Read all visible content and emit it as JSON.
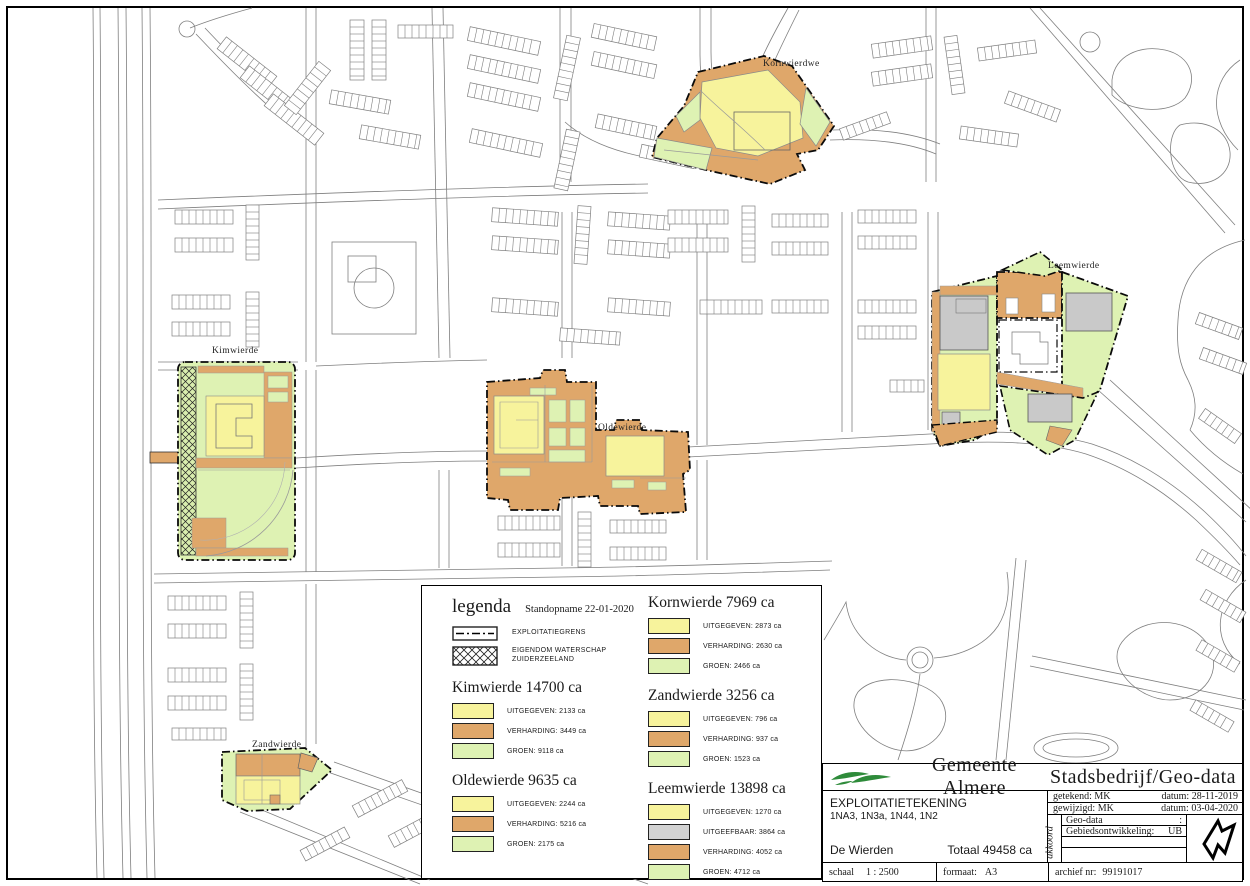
{
  "map": {
    "zone_labels": [
      {
        "id": "kornwierde",
        "text": "Kornwierdwe"
      },
      {
        "id": "kimwierde",
        "text": "Kimwierde"
      },
      {
        "id": "oldewierde",
        "text": "Oldewierde"
      },
      {
        "id": "zandwierde",
        "text": "Zandwierde"
      },
      {
        "id": "leemwierde",
        "text": "Leemwierde"
      }
    ]
  },
  "legend": {
    "title": "legenda",
    "subtitle": "Standopname 22-01-2020",
    "symbols": [
      {
        "key": "exploitatiegrens",
        "label": "EXPLOITATIEGRENS"
      },
      {
        "key": "eigendom-waterschap",
        "label": "EIGENDOM WATERSCHAP ZUIDERZEELAND"
      }
    ],
    "colors": {
      "uitgegeven": "#f7f39c",
      "verharding": "#dfa76a",
      "groen": "#def2b3",
      "uitgeefbaar": "#d2d2d2"
    },
    "columns": [
      {
        "sections": [
          {
            "name": "Kimwierde",
            "total": "14700 ca",
            "rows": [
              {
                "key": "uitgegeven",
                "label": "UITGEGEVEN:",
                "value": "2133 ca"
              },
              {
                "key": "verharding",
                "label": "VERHARDING:",
                "value": "3449 ca"
              },
              {
                "key": "groen",
                "label": "GROEN:",
                "value": "9118 ca"
              }
            ]
          },
          {
            "name": "Oldewierde",
            "total": "9635 ca",
            "rows": [
              {
                "key": "uitgegeven",
                "label": "UITGEGEVEN:",
                "value": "2244 ca"
              },
              {
                "key": "verharding",
                "label": "VERHARDING:",
                "value": "5216 ca"
              },
              {
                "key": "groen",
                "label": "GROEN:",
                "value": "2175 ca"
              }
            ]
          }
        ]
      },
      {
        "sections": [
          {
            "name": "Kornwierde",
            "total": "7969 ca",
            "rows": [
              {
                "key": "uitgegeven",
                "label": "UITGEGEVEN:",
                "value": "2873 ca"
              },
              {
                "key": "verharding",
                "label": "VERHARDING:",
                "value": "2630 ca"
              },
              {
                "key": "groen",
                "label": "GROEN:",
                "value": "2466 ca"
              }
            ]
          },
          {
            "name": "Zandwierde",
            "total": "3256 ca",
            "rows": [
              {
                "key": "uitgegeven",
                "label": "UITGEGEVEN:",
                "value": "796 ca"
              },
              {
                "key": "verharding",
                "label": "VERHARDING:",
                "value": "937 ca"
              },
              {
                "key": "groen",
                "label": "GROEN:",
                "value": "1523 ca"
              }
            ]
          },
          {
            "name": "Leemwierde",
            "total": "13898 ca",
            "rows": [
              {
                "key": "uitgegeven",
                "label": "UITGEGEVEN:",
                "value": "1270 ca"
              },
              {
                "key": "uitgeefbaar",
                "label": "UITGEEFBAAR:",
                "value": "3864 ca"
              },
              {
                "key": "verharding",
                "label": "VERHARDING:",
                "value": "4052 ca"
              },
              {
                "key": "groen",
                "label": "GROEN:",
                "value": "4712 ca"
              }
            ]
          }
        ]
      }
    ]
  },
  "titleblock": {
    "org": "Gemeente Almere",
    "dept": "Stadsbedrijf/Geo-data",
    "doc_type": "EXPLOITATIETEKENING",
    "doc_codes": "1NA3, 1N3a, 1N44, 1N2",
    "area_name": "De Wierden",
    "total": "Totaal 49458 ca",
    "drawn_label": "getekend:  MK",
    "drawn_date": "datum:  28-11-2019",
    "modified_label": "gewijzigd:  MK",
    "modified_date": "datum:  03-04-2020",
    "akkoord_label": "akkoord",
    "approval_rows": [
      {
        "label": "Geo-data",
        "value": ":"
      },
      {
        "label": "Gebiedsontwikkeling:",
        "value": "UB"
      },
      {
        "label": "",
        "value": ""
      },
      {
        "label": "",
        "value": ""
      }
    ],
    "scale_label": "schaal",
    "scale_value": "1 : 2500",
    "format_label": "formaat:",
    "format_value": "A3",
    "archive_label": "archief nr:",
    "archive_value": "99191017"
  }
}
